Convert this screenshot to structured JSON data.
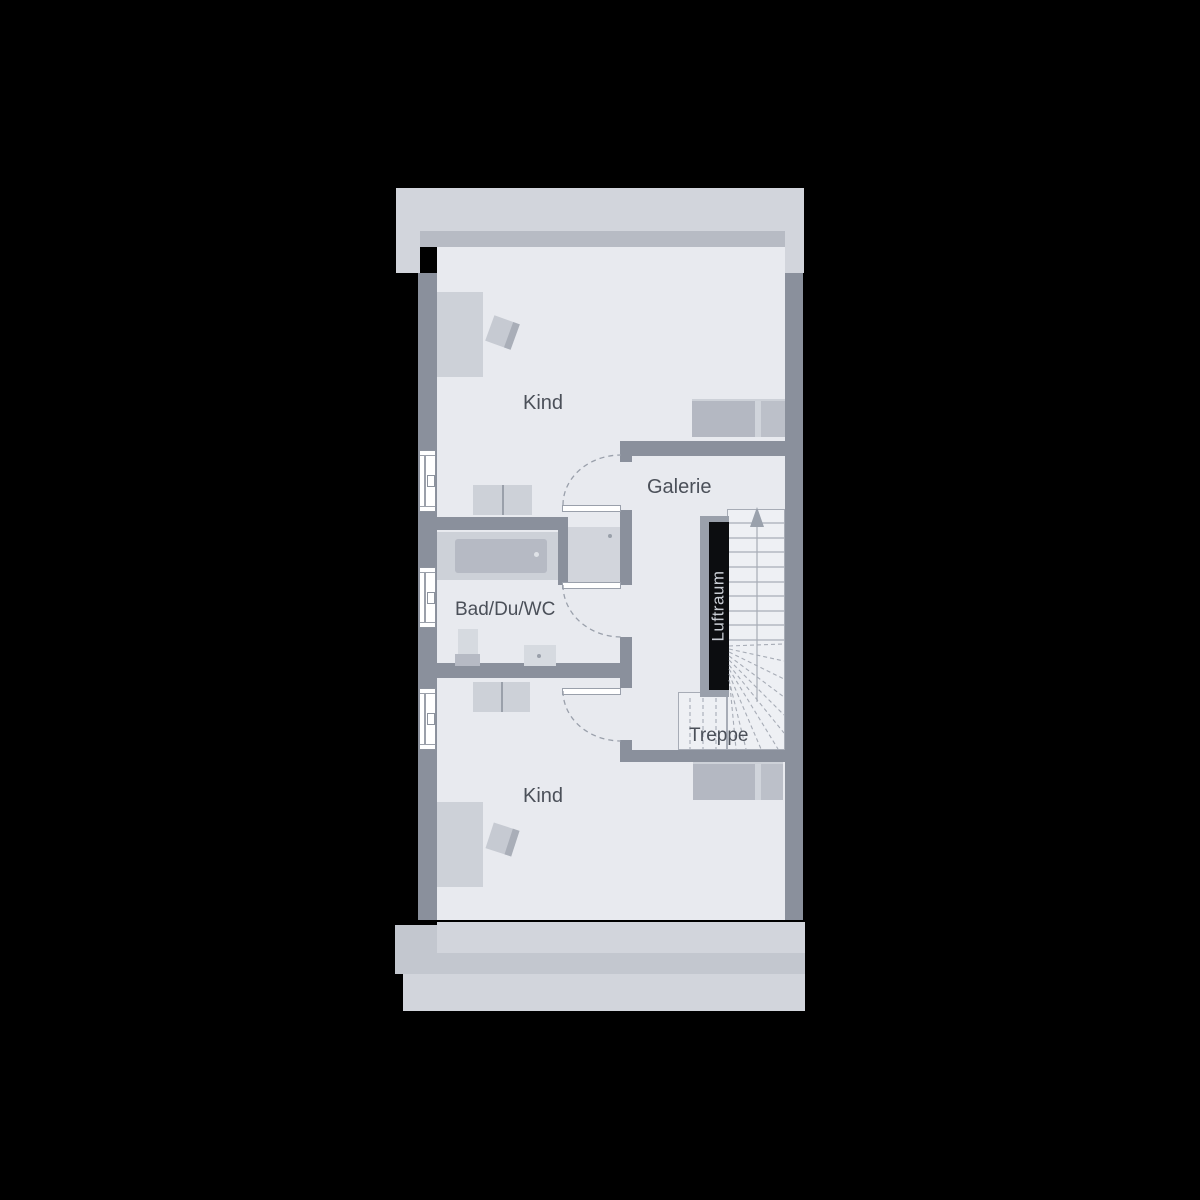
{
  "plan": {
    "labels": {
      "kind_top": "Kind",
      "galerie": "Galerie",
      "bad": "Bad/Du/WC",
      "kind_bottom": "Kind",
      "treppe": "Treppe",
      "luftraum": "Luftraum"
    },
    "stairs": {
      "direction": "up",
      "straight_treads": 9,
      "winder_treads": "dashed-fan"
    },
    "windows_left_wall": 3,
    "door_openings": 3,
    "palette": {
      "background": "#000000",
      "roof_band": "#d2d5dc",
      "exterior_wall_band": "#b7bbc4",
      "wall": "#8a909c",
      "floor": "#e8eaef",
      "stair_floor": "#eef0f4",
      "furniture_light": "#cdd1d8",
      "furniture_medium": "#b6bac4",
      "void_black": "#0c0d10",
      "label_text": "#4b5059",
      "line_gray": "#a7acb6",
      "window_white": "#ffffff",
      "luftraum_text": "#c9cdd4"
    }
  }
}
